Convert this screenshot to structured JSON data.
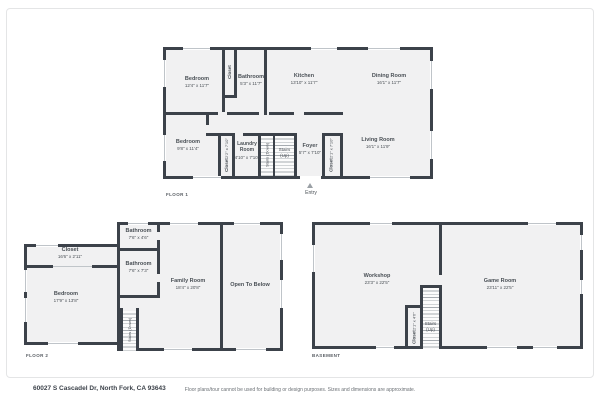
{
  "colors": {
    "wall": "#3c424a",
    "floor": "#f1f1f2",
    "window_line": "#bfc4c9",
    "text": "#4a5056"
  },
  "footer": {
    "address": "60027 S Cascadel Dr, North Fork, CA 93643",
    "disclaimer": "Floor plans/tour cannot be used for building or design purposes. Sizes and dimensions are approximate."
  },
  "floor1": {
    "label": "FLOOR 1",
    "entry": "Entry",
    "rooms": {
      "bedroom1": {
        "name": "Bedroom",
        "dims": "12'4\" x 11'7\""
      },
      "closet_top": {
        "name": "Closet"
      },
      "bathroom": {
        "name": "Bathroom",
        "dims": "5'3\" x 11'7\""
      },
      "kitchen": {
        "name": "Kitchen",
        "dims": "13'10\" x 11'7\""
      },
      "dining": {
        "name": "Dining Room",
        "dims": "16'1\" x 11'7\""
      },
      "bedroom2": {
        "name": "Bedroom",
        "dims": "9'8\" x 11'4\""
      },
      "closet_hall": {
        "name": "Closet",
        "dims": "2'2\" x 7'10\""
      },
      "laundry": {
        "name": "Laundry Room",
        "dims": "4'10\" x 7'10\""
      },
      "stairs_down": {
        "name": "Stairs (Down)"
      },
      "stairs_up": {
        "line1": "Stairs",
        "line2": "(Up)"
      },
      "foyer": {
        "name": "Foyer",
        "dims": "5'7\" x 7'10\""
      },
      "closet_foyer": {
        "name": "Closet",
        "dims": "2'1\" x 7'10\""
      },
      "living": {
        "name": "Living Room",
        "dims": "16'1\" x 11'9\""
      }
    }
  },
  "floor2": {
    "label": "FLOOR 2",
    "rooms": {
      "closet": {
        "name": "Closet",
        "dims": "16'6\" x 2'11\""
      },
      "bathroom_top": {
        "name": "Bathroom",
        "dims": "7'6\" x 4'6\""
      },
      "bathroom_mid": {
        "name": "Bathroom",
        "dims": "7'6\" x 7'3\""
      },
      "family": {
        "name": "Family Room",
        "dims": "18'4\" x 20'8\""
      },
      "bedroom": {
        "name": "Bedroom",
        "dims": "17'9\" x 13'8\""
      },
      "stairs_down": {
        "name": "Stairs (Down)"
      },
      "open_below": {
        "name": "Open To Below"
      }
    }
  },
  "basement": {
    "label": "BASEMENT",
    "rooms": {
      "workshop": {
        "name": "Workshop",
        "dims": "23'3\" x 22'5\""
      },
      "game": {
        "name": "Game Room",
        "dims": "23'11\" x 22'5\""
      },
      "closet": {
        "name": "Closet",
        "dims": "2'1\" x 4'6\""
      },
      "stairs_up": {
        "line1": "Stairs",
        "line2": "(Up)"
      }
    }
  }
}
